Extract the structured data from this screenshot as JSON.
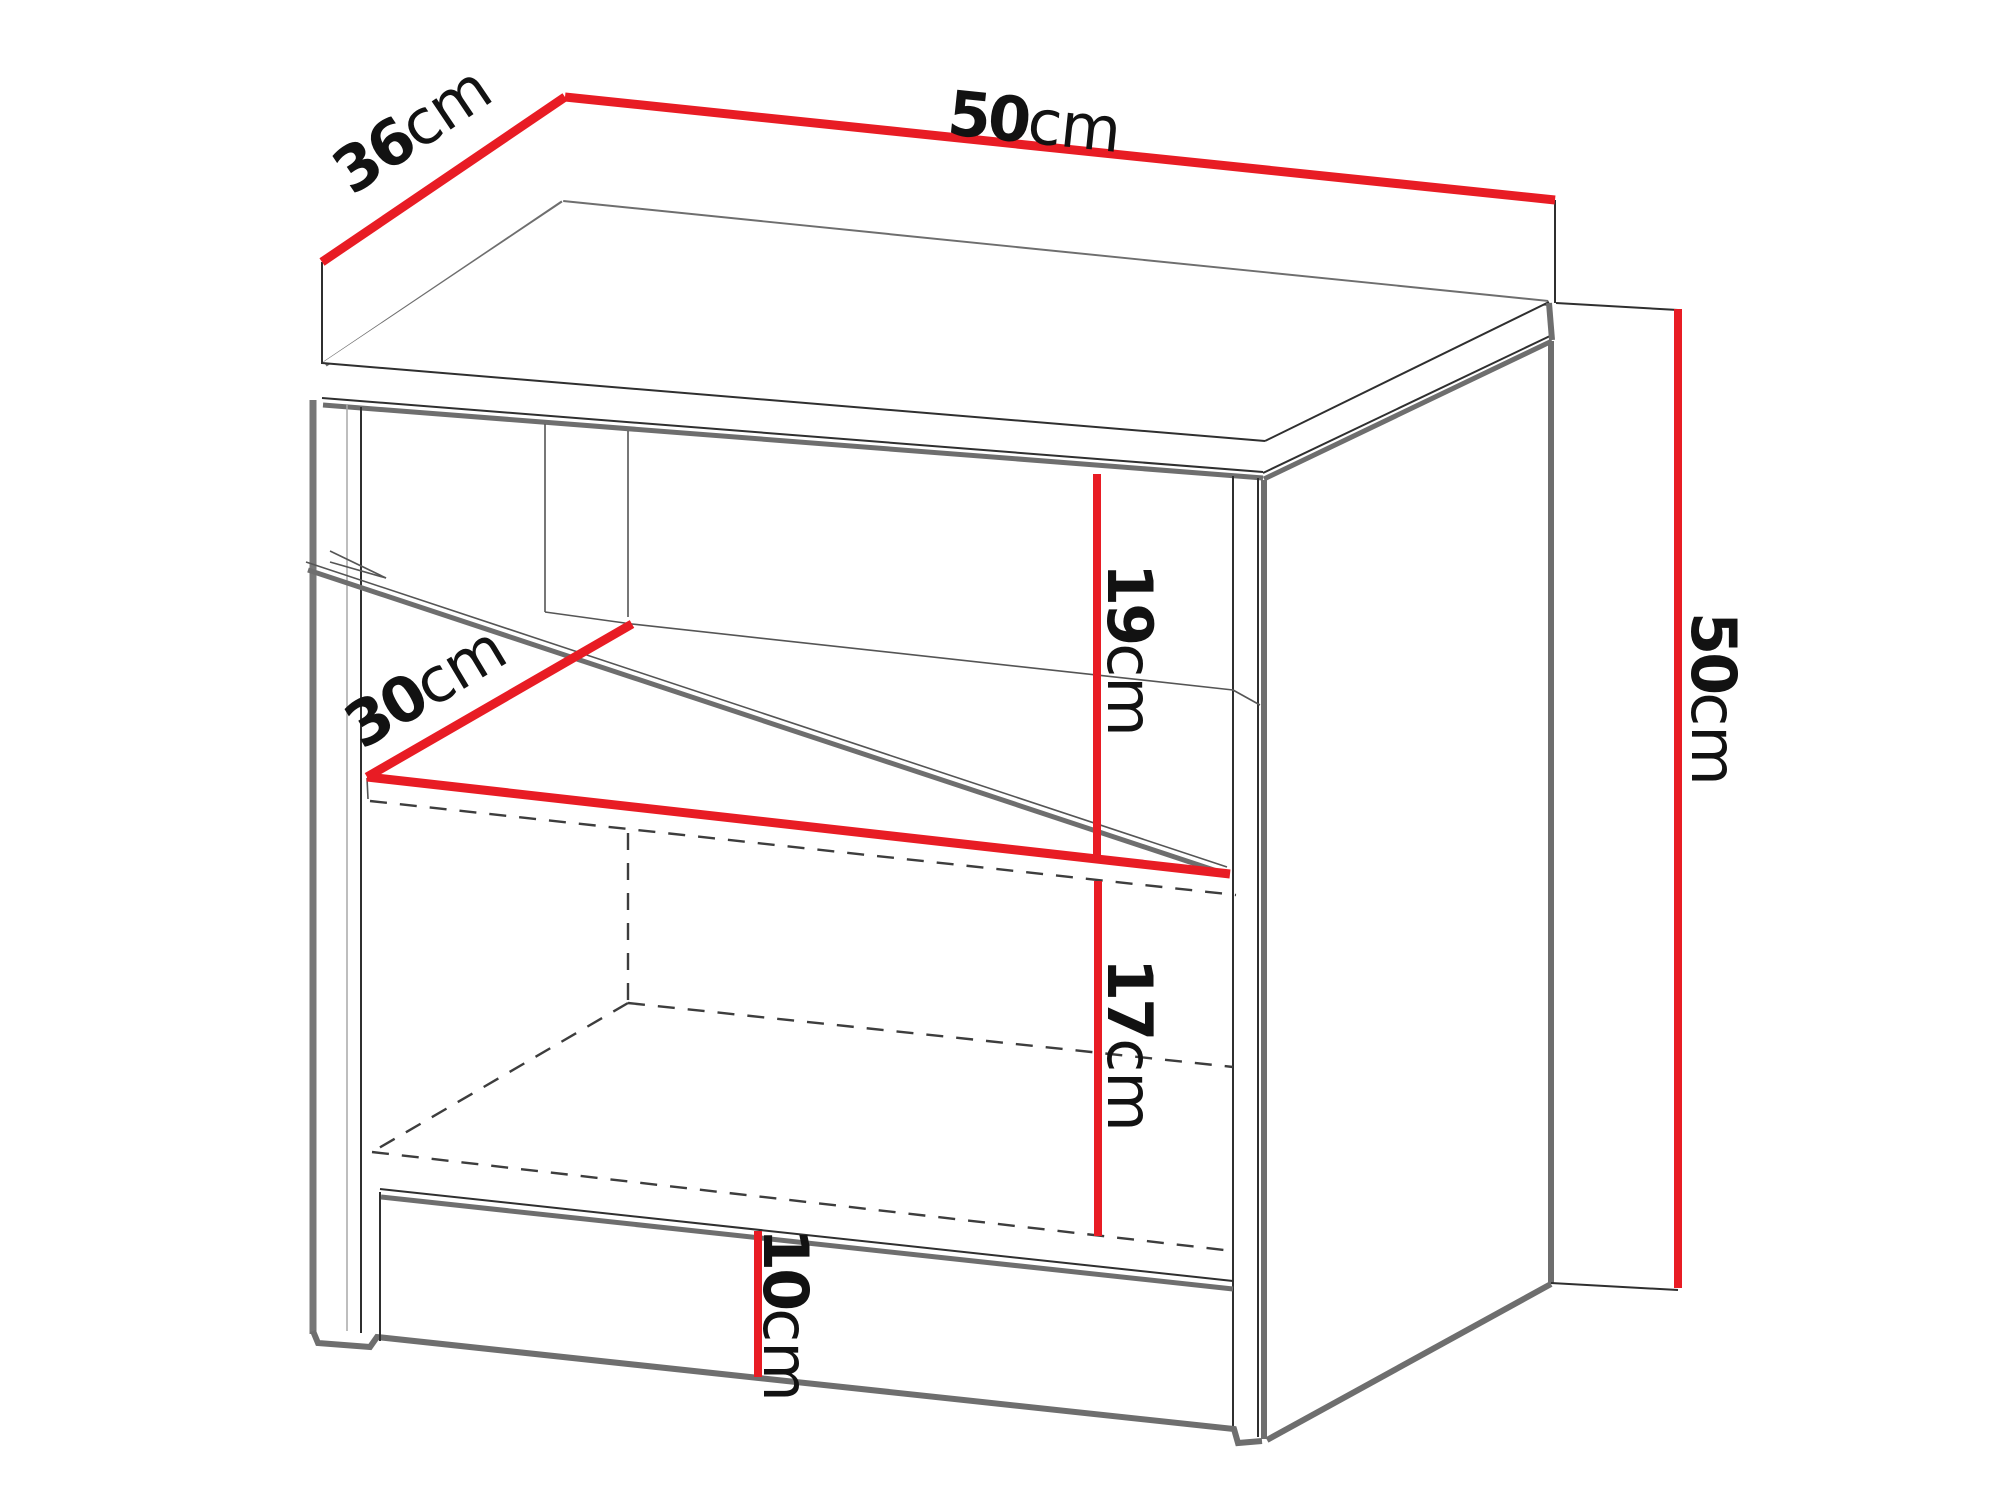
{
  "diagram": {
    "name": "cabinet-dimension-drawing",
    "description": "Technical line drawing of a bedside cabinet with open shelves and a bottom drawer, annotated with red dimension lines",
    "colors": {
      "dimension_line": "#e81c24",
      "outline_dark": "#2f2f2f",
      "outline_gray": "#6e6e6e",
      "hidden_line": "#3d3d3d",
      "text": "#121212",
      "background": "#ffffff"
    },
    "labels": {
      "width": {
        "value": "50",
        "unit": "cm"
      },
      "depth": {
        "value": "36",
        "unit": "cm"
      },
      "height": {
        "value": "50",
        "unit": "cm"
      },
      "interior_depth": {
        "value": "30",
        "unit": "cm"
      },
      "upper_shelf": {
        "value": "19",
        "unit": "cm"
      },
      "lower_shelf": {
        "value": "17",
        "unit": "cm"
      },
      "drawer": {
        "value": "10",
        "unit": "cm"
      }
    }
  }
}
